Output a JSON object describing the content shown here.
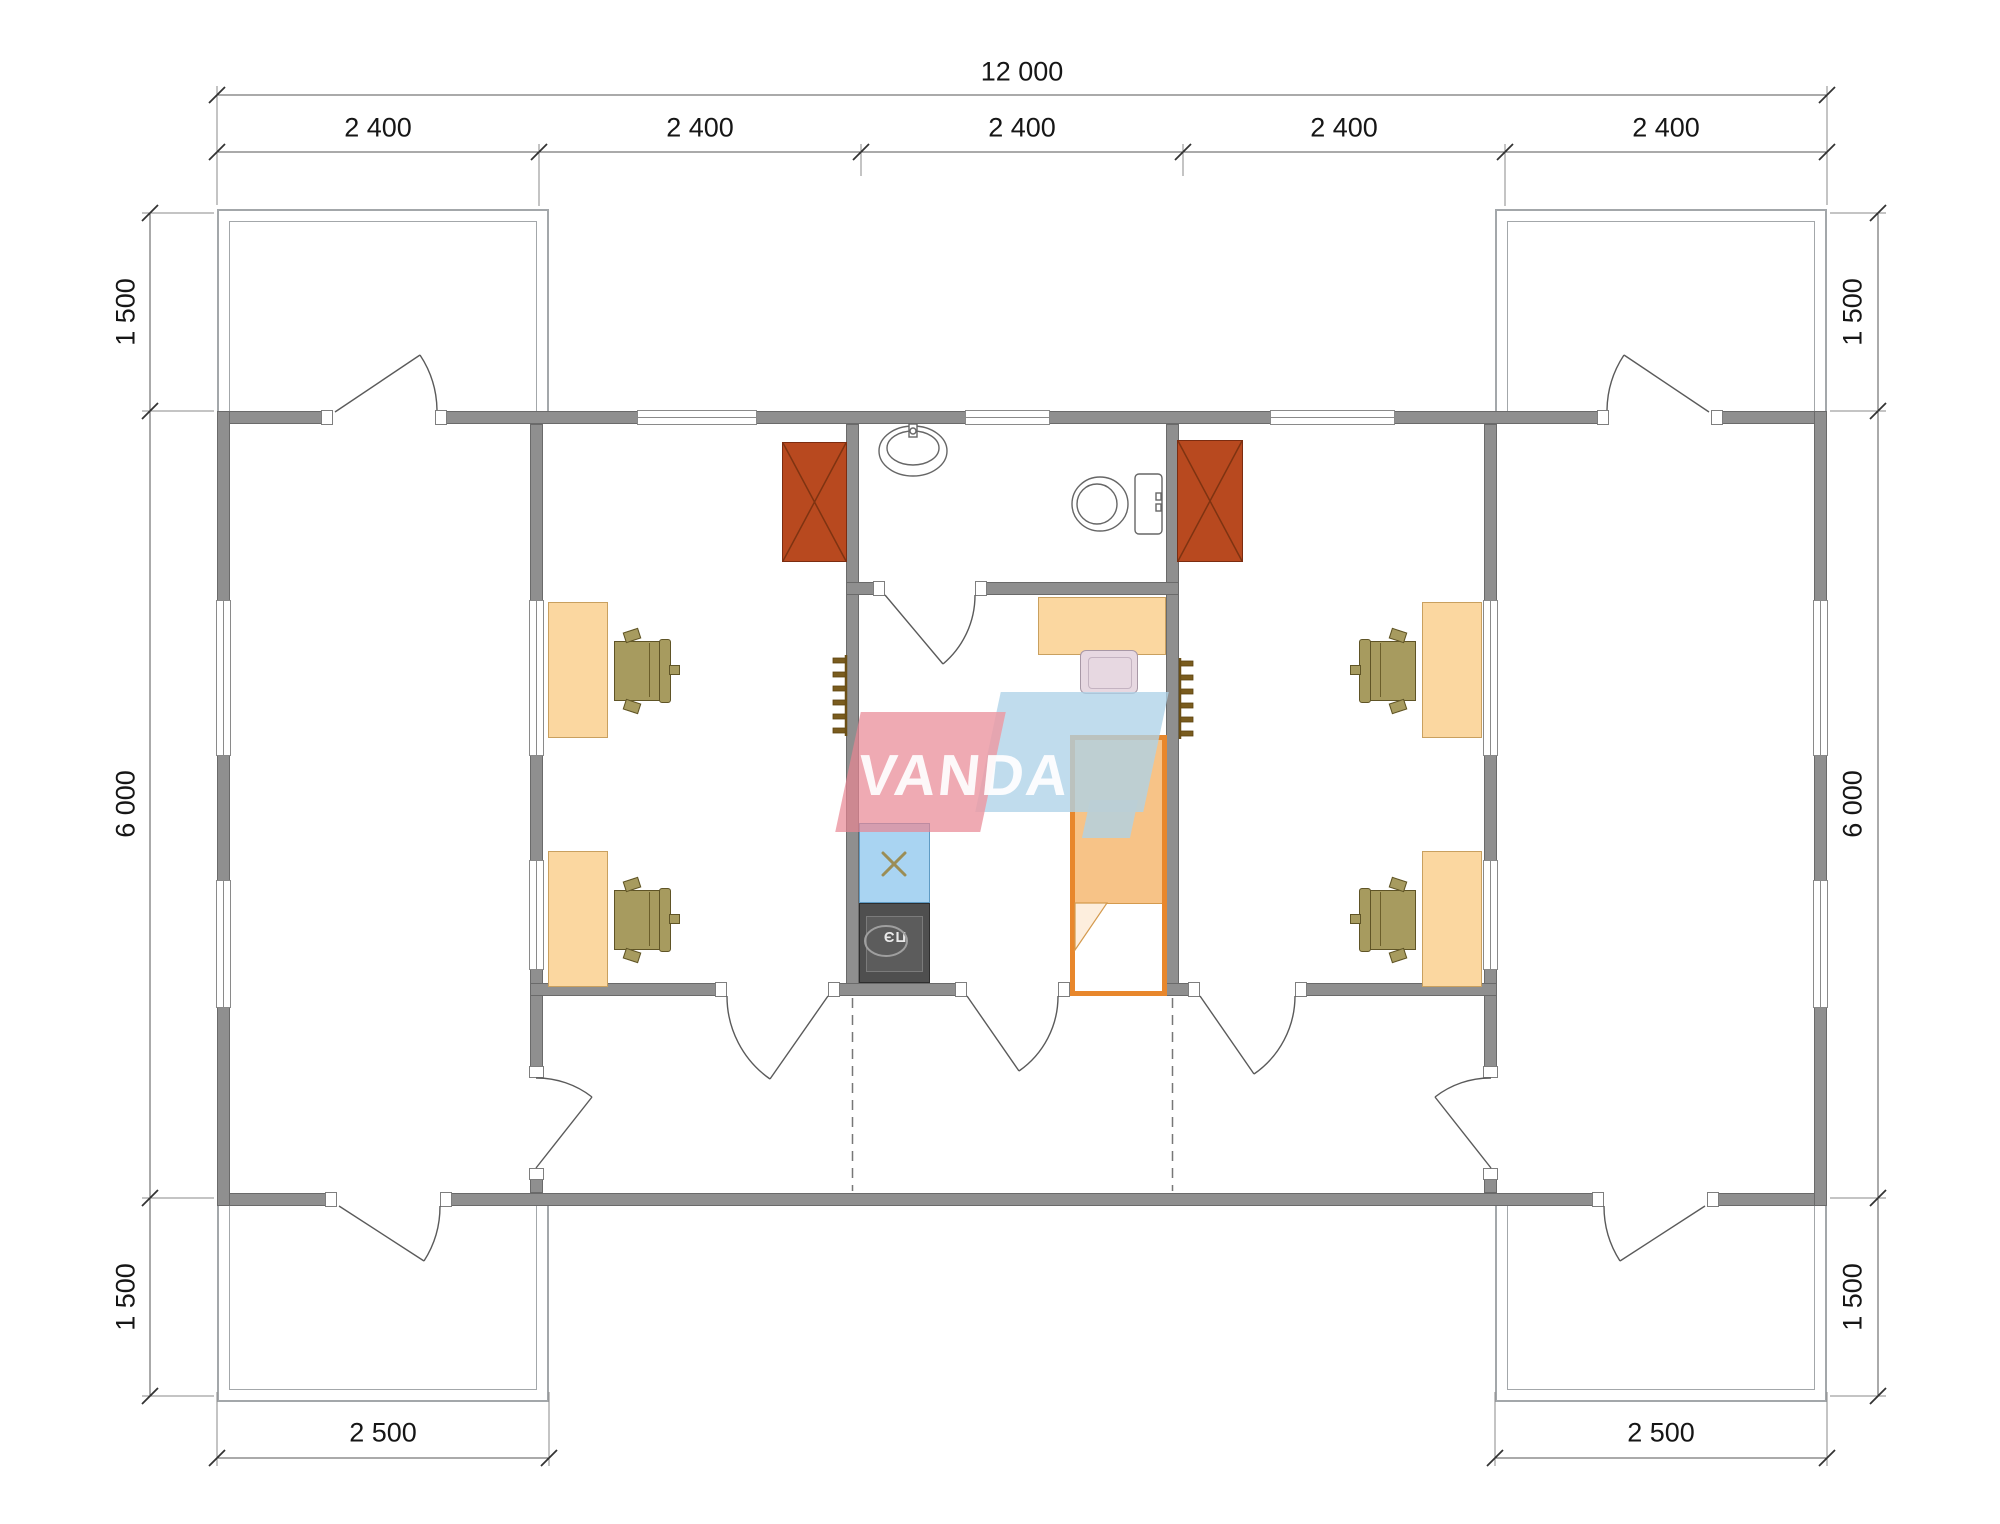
{
  "watermark": {
    "text": "VANDA",
    "front_color": "#e78592",
    "back_color": "#aed3e8"
  },
  "stove": {
    "label": "ПЭ"
  },
  "dimensions": {
    "top_total": "12 000",
    "top_segments": [
      "2 400",
      "2 400",
      "2 400",
      "2 400",
      "2 400"
    ],
    "left": [
      "1 500",
      "6 000",
      "1 500"
    ],
    "right": [
      "1 500",
      "6 000",
      "1 500"
    ],
    "bottom_left": "2 500",
    "bottom_right": "2 500"
  },
  "colors": {
    "wall": "#8f8f8f",
    "wardrobe": "#b8491f",
    "desk": "#fbd7a0",
    "chair": "#a79b5f",
    "kitchen_counter": "#a9d4f2",
    "stove": "#4f4f4f",
    "bed_frame": "#e8872c",
    "bed_blanket": "#f7c387",
    "radiator": "#7a5c1e"
  },
  "fixtures": {
    "sink": "sink-icon",
    "toilet": "toilet-icon",
    "kitchen_sink_cross": "cross-icon",
    "wardrobe_cross": "x-icon"
  }
}
